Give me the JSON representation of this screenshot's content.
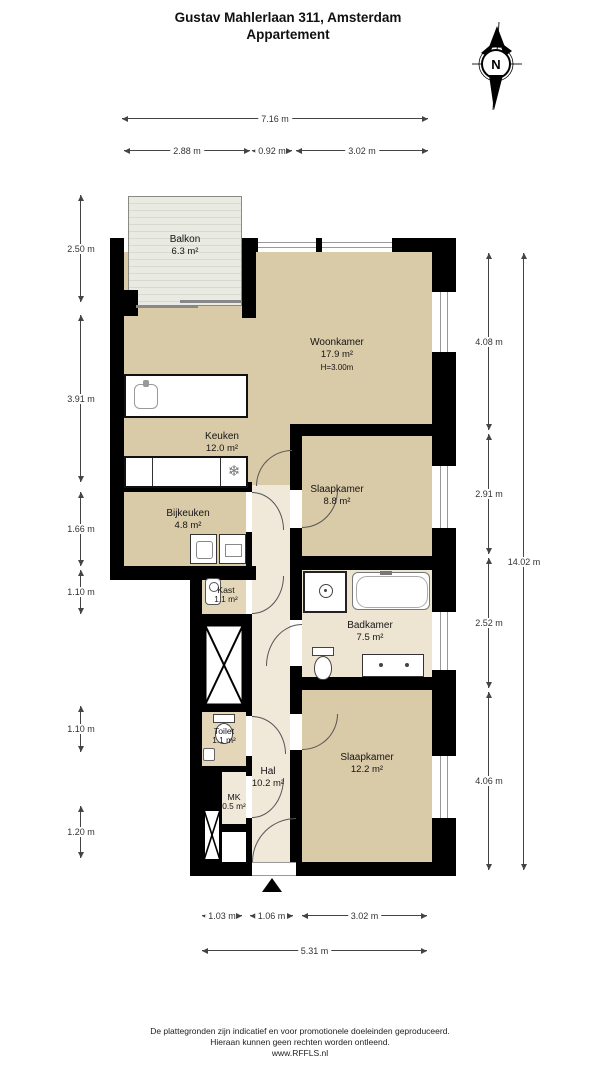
{
  "title": {
    "line1": "Gustav Mahlerlaan 311, Amsterdam",
    "line2": "Appartement"
  },
  "compass": {
    "label": "N"
  },
  "rooms": {
    "balkon": {
      "name": "Balkon",
      "area": "6.3 m²"
    },
    "woonkamer": {
      "name": "Woonkamer",
      "area": "17.9 m²",
      "height": "H=3.00m"
    },
    "keuken": {
      "name": "Keuken",
      "area": "12.0 m²"
    },
    "bijkeuken": {
      "name": "Bijkeuken",
      "area": "4.8 m²"
    },
    "slaapkamer1": {
      "name": "Slaapkamer",
      "area": "8.8 m²"
    },
    "kast": {
      "name": "Kast",
      "area": "1.1 m²"
    },
    "badkamer": {
      "name": "Badkamer",
      "area": "7.5 m²"
    },
    "toilet": {
      "name": "Toilet",
      "area": "1.1 m²"
    },
    "hal": {
      "name": "Hal",
      "area": "10.2 m²"
    },
    "mk": {
      "name": "MK",
      "area": "0.5 m²"
    },
    "slaapkamer2": {
      "name": "Slaapkamer",
      "area": "12.2 m²"
    }
  },
  "dimensions": {
    "top_total": "7.16 m",
    "top_segments": [
      "2.88 m",
      "0.92 m",
      "3.02 m"
    ],
    "left": [
      "2.50 m",
      "3.91 m",
      "1.66 m",
      "1.10 m",
      "1.10 m",
      "1.20 m"
    ],
    "right": [
      "4.08 m",
      "2.91 m",
      "2.52 m",
      "4.06 m"
    ],
    "right_total": "14.02 m",
    "bottom_segments": [
      "1.03 m",
      "1.06 m",
      "3.02 m"
    ],
    "bottom_total": "5.31 m"
  },
  "icons": {
    "freezer": "❄"
  },
  "colors": {
    "wall": "#000000",
    "floor_main": "#d9caa8",
    "floor_light": "#f0e9da",
    "floor_side": "#e4d7b9"
  },
  "footer": {
    "line1": "De plattegronden zijn indicatief en voor promotionele doeleinden geproduceerd.",
    "line2": "Hieraan kunnen geen rechten worden ontleend.",
    "line3": "www.RFFLS.nl"
  }
}
